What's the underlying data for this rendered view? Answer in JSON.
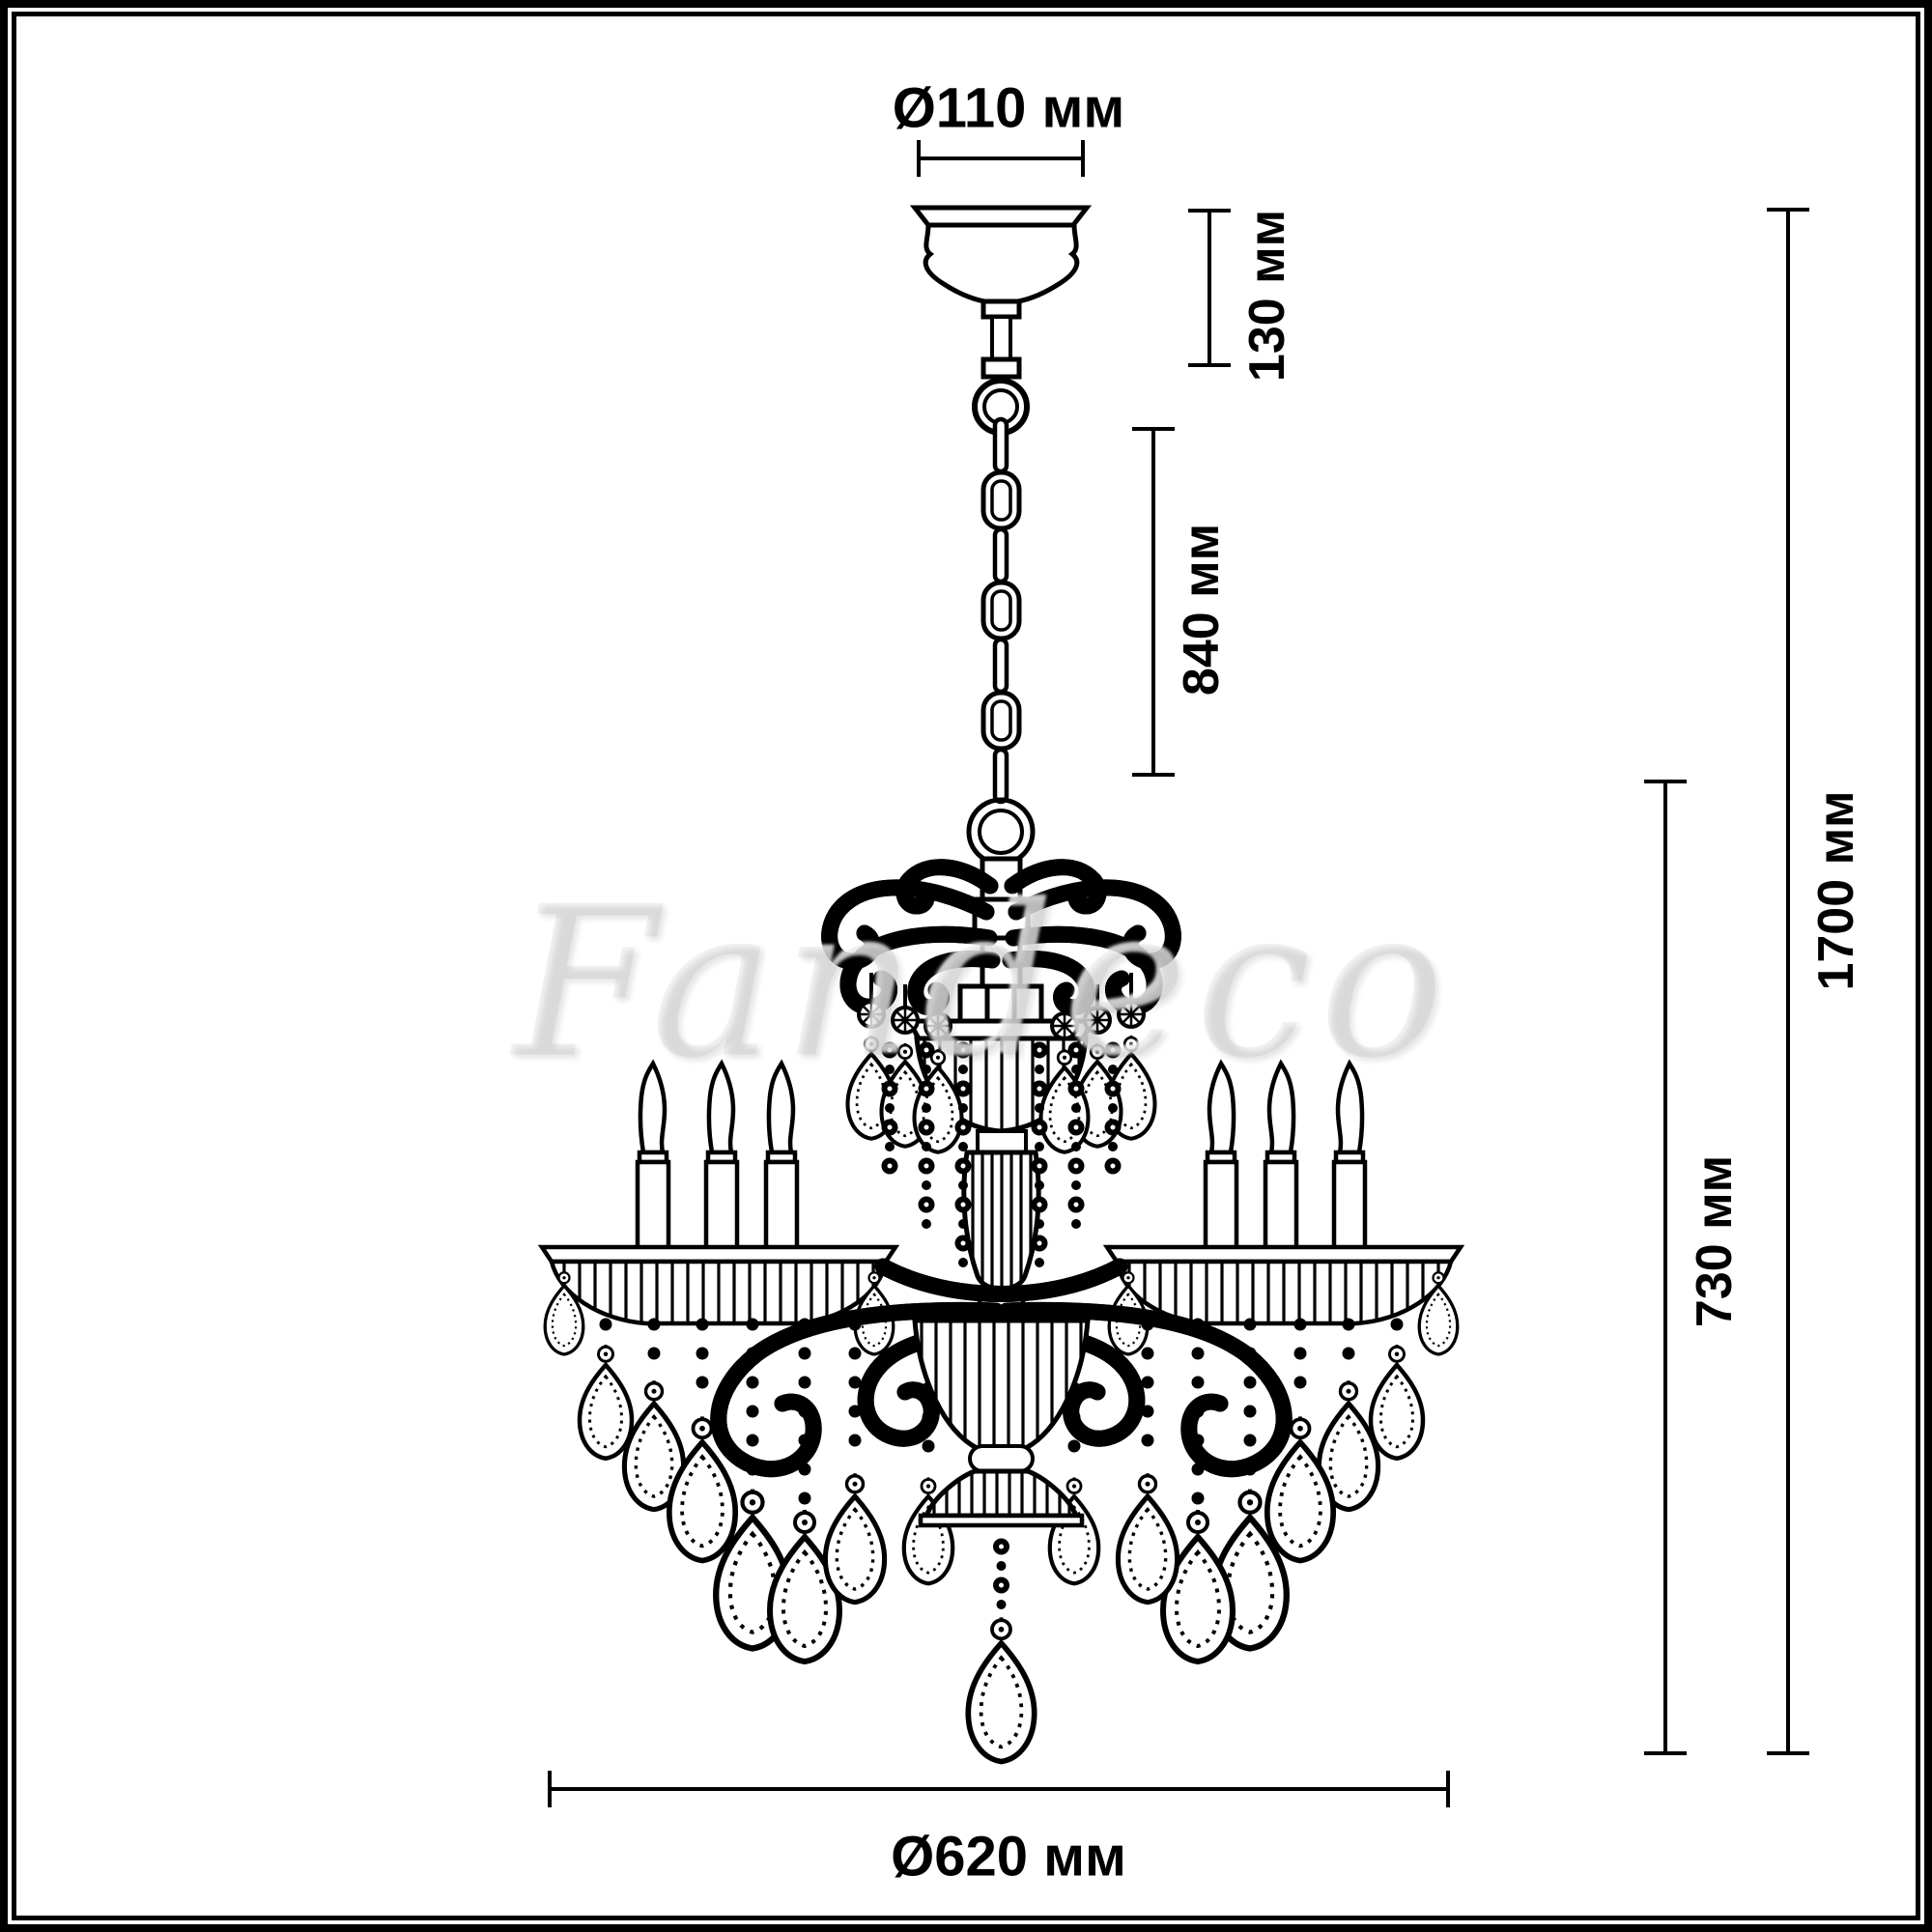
{
  "page": {
    "background": "#ffffff",
    "frame_color": "#000000",
    "line_color": "#000000"
  },
  "watermark": {
    "text": "Fandeco"
  },
  "labels": {
    "canopy_diameter": "Ø110 мм",
    "canopy_height": "130 мм",
    "chain_length": "840 мм",
    "total_height": "1700 мм",
    "body_height": "730 мм",
    "body_diameter": "Ø620 мм"
  },
  "dimensions_mm": {
    "canopy_diameter": 110,
    "canopy_height": 130,
    "chain_length": 840,
    "total_height": 1700,
    "body_height": 730,
    "body_diameter": 620
  },
  "drawing": {
    "subject": "six-arm crystal chandelier with candle lights, chain suspension, ceiling canopy, bead strands and teardrop crystal pendants",
    "candle_count_visible": 6
  }
}
